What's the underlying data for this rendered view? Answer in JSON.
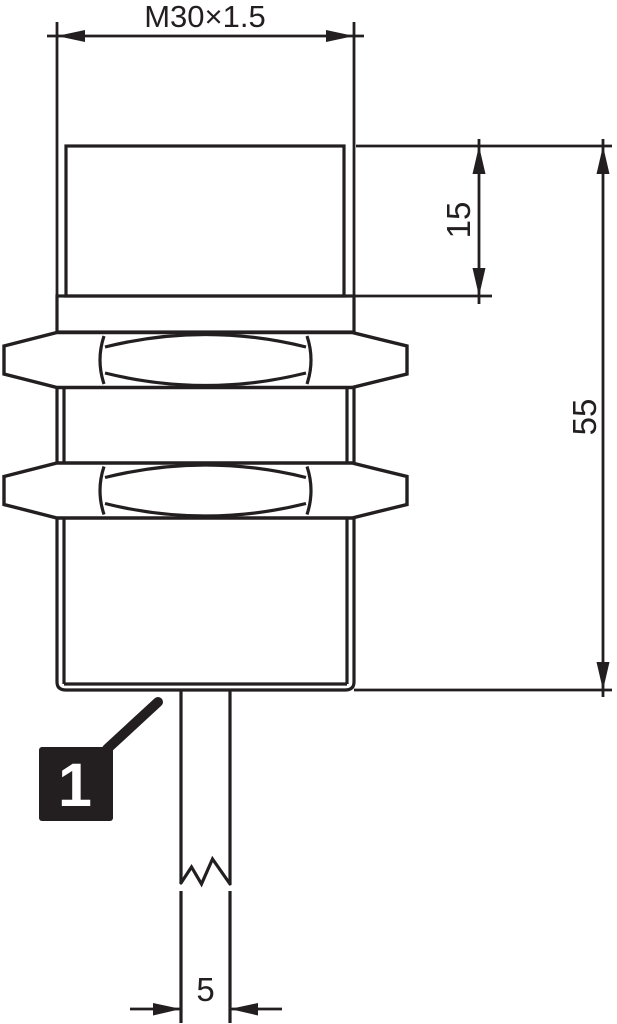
{
  "diagram": {
    "type": "technical-drawing",
    "subject": "threaded-cylindrical-sensor-side-view",
    "dimensions": {
      "thread": "M30×1.5",
      "head_height": "15",
      "overall_length": "55",
      "cable_width": "5"
    },
    "callouts": [
      {
        "number": "1"
      }
    ],
    "colors": {
      "line": "#231f20",
      "background": "#ffffff",
      "callout_fill": "#231f20",
      "callout_text": "#ffffff"
    }
  }
}
